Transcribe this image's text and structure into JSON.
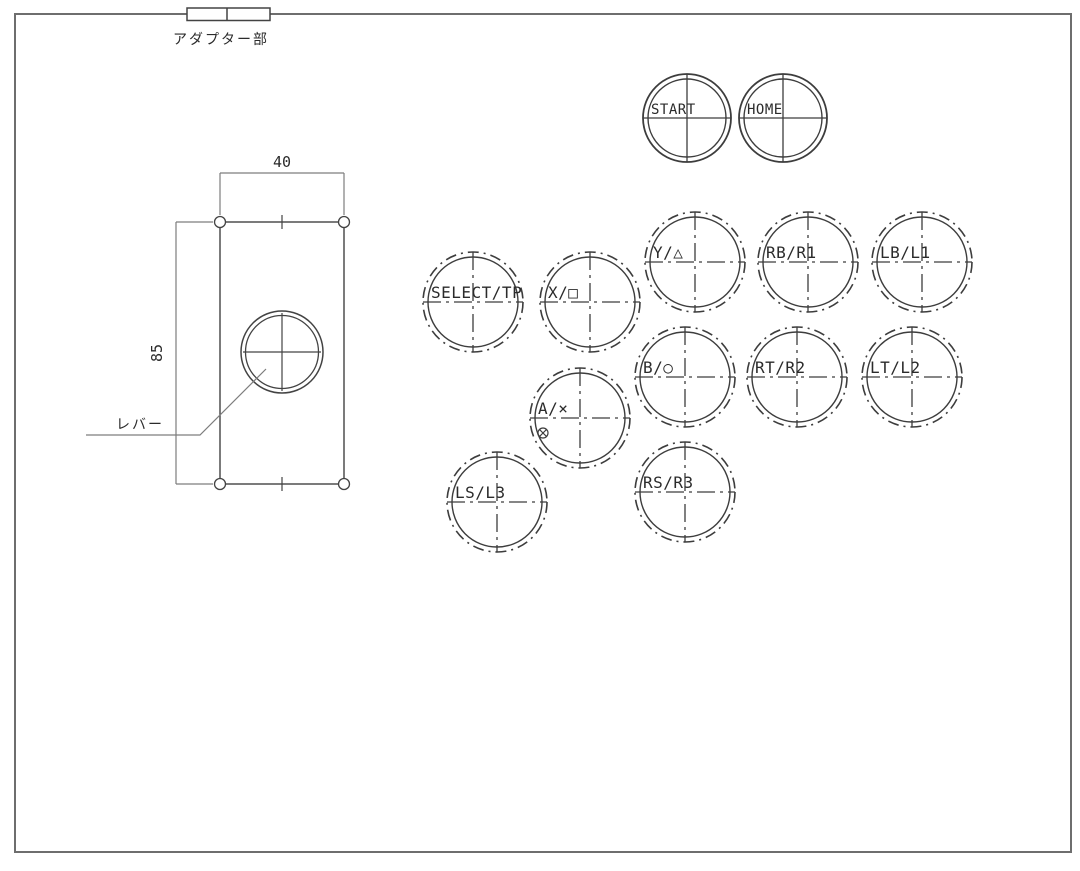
{
  "drawing_title": "arcade-stick-panel-drawing",
  "adapter": {
    "label": "アダプター部"
  },
  "plate": {
    "width_dim": "40",
    "height_dim": "85",
    "lever_label": "レバー",
    "geometry": {
      "rect": [
        220,
        222,
        124,
        262
      ],
      "corner_hole_radius": 5.5,
      "lever_center": [
        282,
        352
      ],
      "lever_r_outer": 41,
      "lever_r_inner": 36.5,
      "width_dim_line_y": 173,
      "height_dim_line_x": 176,
      "leader_points": "266,369 200,435 86,435"
    }
  },
  "buttons": [
    {
      "id": "start",
      "label": "START",
      "cx": 687,
      "cy": 118,
      "r_outer": 44,
      "r_inner": 39,
      "style": "solid",
      "font_size": 14
    },
    {
      "id": "home",
      "label": "HOME",
      "cx": 783,
      "cy": 118,
      "r_outer": 44,
      "r_inner": 39,
      "style": "solid",
      "font_size": 14
    },
    {
      "id": "y-triangle",
      "label": "Y/△",
      "cx": 695,
      "cy": 262,
      "r_outer": 50,
      "r_inner": 45,
      "style": "dashdot",
      "font_size": 16
    },
    {
      "id": "rb-r1",
      "label": "RB/R1",
      "cx": 808,
      "cy": 262,
      "r_outer": 50,
      "r_inner": 45,
      "style": "dashdot",
      "font_size": 16
    },
    {
      "id": "lb-l1",
      "label": "LB/L1",
      "cx": 922,
      "cy": 262,
      "r_outer": 50,
      "r_inner": 45,
      "style": "dashdot",
      "font_size": 16
    },
    {
      "id": "select-tp",
      "label": "SELECT/TP",
      "cx": 473,
      "cy": 302,
      "r_outer": 50,
      "r_inner": 45,
      "style": "dashdot",
      "font_size": 16
    },
    {
      "id": "x-square",
      "label": "X/□",
      "cx": 590,
      "cy": 302,
      "r_outer": 50,
      "r_inner": 45,
      "style": "dashdot",
      "font_size": 16
    },
    {
      "id": "b-circle",
      "label": "B/○",
      "cx": 685,
      "cy": 377,
      "r_outer": 50,
      "r_inner": 45,
      "style": "dashdot",
      "font_size": 16
    },
    {
      "id": "rt-r2",
      "label": "RT/R2",
      "cx": 797,
      "cy": 377,
      "r_outer": 50,
      "r_inner": 45,
      "style": "dashdot",
      "font_size": 16
    },
    {
      "id": "lt-l2",
      "label": "LT/L2",
      "cx": 912,
      "cy": 377,
      "r_outer": 50,
      "r_inner": 45,
      "style": "dashdot",
      "font_size": 16
    },
    {
      "id": "a-cross",
      "label": "A/×",
      "cx": 580,
      "cy": 418,
      "r_outer": 50,
      "r_inner": 45,
      "style": "dashdot",
      "font_size": 16,
      "sub_symbol": {
        "type": "circle-x",
        "cx": 543,
        "cy": 433,
        "r": 5
      }
    },
    {
      "id": "ls-l3",
      "label": "LS/L3",
      "cx": 497,
      "cy": 502,
      "r_outer": 50,
      "r_inner": 45,
      "style": "dashdot",
      "font_size": 16
    },
    {
      "id": "rs-r3",
      "label": "RS/R3",
      "cx": 685,
      "cy": 492,
      "r_outer": 50,
      "r_inner": 45,
      "style": "dashdot",
      "font_size": 16
    }
  ],
  "colors": {
    "background": "#ffffff",
    "border": "#6e6e6e",
    "drawing_line": "#434343",
    "button_line": "#3d3d3d",
    "dim_line": "#7d7d7d",
    "text": "#2b2b2b"
  }
}
